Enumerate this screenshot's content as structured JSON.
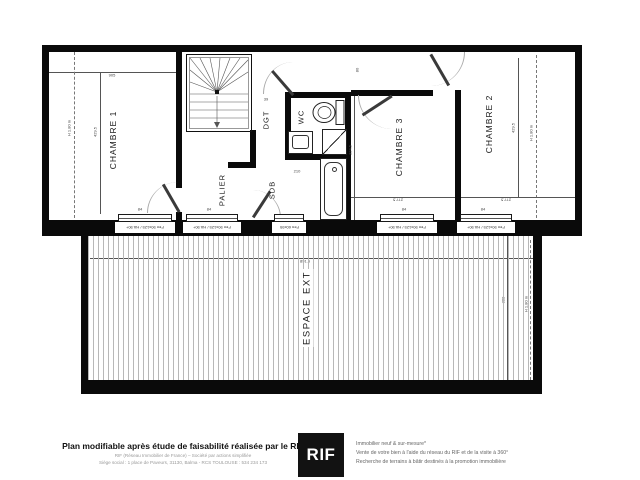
{
  "plan": {
    "rooms": {
      "chambre1": "CHAMBRE 1",
      "chambre2": "CHAMBRE 2",
      "chambre3": "CHAMBRE 3",
      "palier": "PALIER",
      "dgt": "DGT",
      "wc": "WC",
      "sdb": "SDB",
      "espace_ext": "ESPACE EXT"
    },
    "dims": {
      "ch1_width": "905",
      "ch1_height": "429.5",
      "ch1_headroom": "H 1.80 m",
      "ch2_height": "429.5",
      "ch2_headroom": "H 1.80 m",
      "ch2_width": "277.5",
      "ch3_width": "277.5",
      "ch3_height": "324.5",
      "sdb_width": "210",
      "door_a": "80",
      "door_b": "39",
      "window_width": "84",
      "terrace_width": "891.5",
      "terrace_height": "388",
      "terrace_headroom_left": "H 1.80 m",
      "terrace_headroom_right": "H 1.80 m"
    },
    "window_label": "Fen 90x125 / HA 90+",
    "window_label_small": "Fen 60x95"
  },
  "colors": {
    "wall": "#0a0a0a",
    "logo_bg": "#121212",
    "logo_text": "#ffffff",
    "hatch_line": "#b8b8b8"
  },
  "footer": {
    "title": "Plan modifiable après étude de faisabilité réalisée par le RIF",
    "sub1": "RIF (Réseau Immobilier de France) – Société par actions simplifiée",
    "sub2": "Siège social : 1 place de Paveurs, 31130, Balma - RCS TOULOUSE : 534 234 173",
    "logo_text": "RIF",
    "right1": "Immobilier neuf & sur-mesure*",
    "right2": "Vente de votre bien à l'aide du réseau du RIF et de la visite à 360°",
    "right3": "Recherche de terrains à bâtir destinés à la promotion immobilière"
  }
}
